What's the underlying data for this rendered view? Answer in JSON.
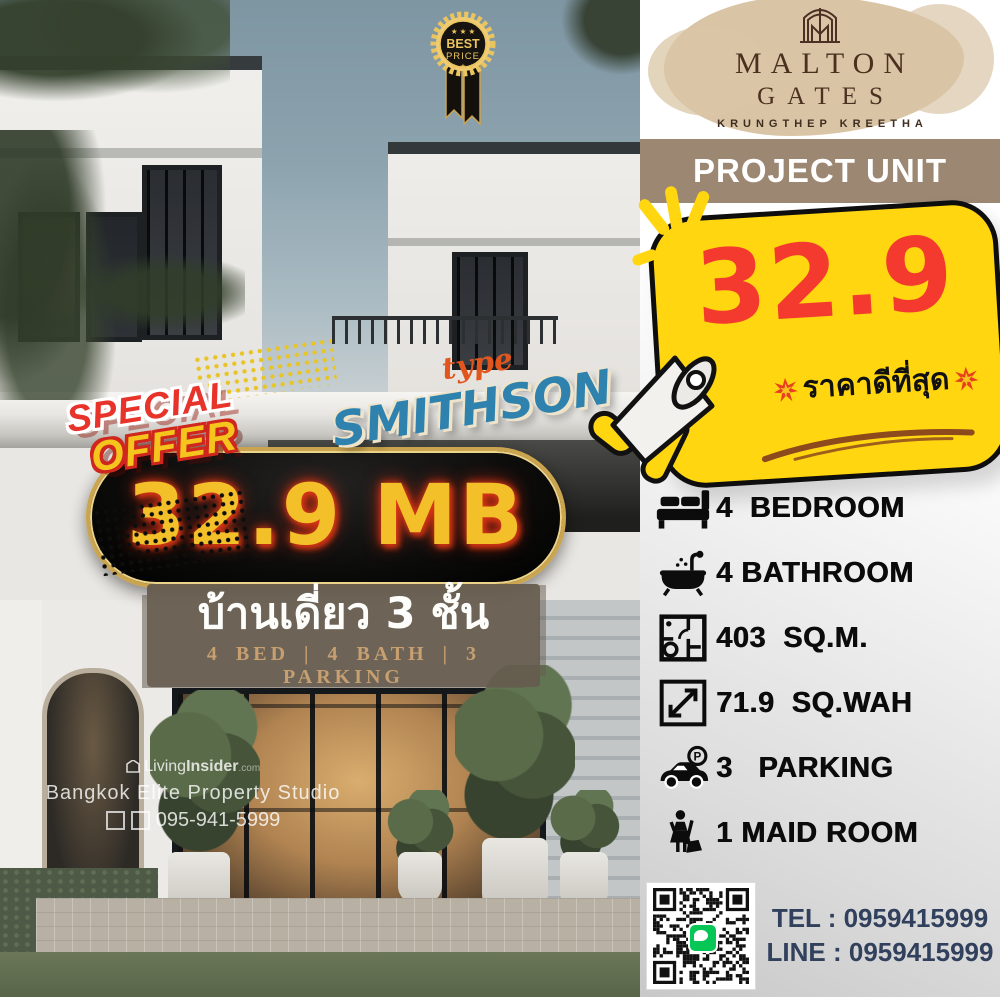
{
  "badges": {
    "best_price": {
      "stars_top": "★ ★ ★",
      "line1": "BEST",
      "line2": "PRICE",
      "stars_bottom": "★ ★ ★"
    },
    "special_offer": {
      "line1": "SPECIAL",
      "line2": "OFFER"
    }
  },
  "type_label": {
    "prefix": "type",
    "name": "SMITHSON"
  },
  "price_tag": {
    "value": "32.9 MB"
  },
  "thai_banner": {
    "title": "บ้านเดี่ยว 3 ชั้น",
    "subtitle": "4 BED | 4 BATH | 3 PARKING"
  },
  "watermark": {
    "brand_light": "Living",
    "brand_bold": "Insider",
    "brand_suffix": ".com",
    "studio": "Bangkok Elite Property Studio",
    "phone": "095-941-5999"
  },
  "brand": {
    "name1": "MALTON",
    "name2": "GATES",
    "location": "KRUNGTHEP KREETHA"
  },
  "header": {
    "title": "PROJECT UNIT"
  },
  "price_bubble": {
    "price": "32.9",
    "caption": "ราคาดีที่สุด"
  },
  "features": [
    {
      "icon": "bed-icon",
      "label": "4  BEDROOM"
    },
    {
      "icon": "bathtub-icon",
      "label": "4 BATHROOM"
    },
    {
      "icon": "floorplan-icon",
      "label": "403  SQ.M."
    },
    {
      "icon": "area-icon",
      "label": "71.9  SQ.WAH"
    },
    {
      "icon": "parking-icon",
      "label": "3   PARKING"
    },
    {
      "icon": "maid-icon",
      "label": "1 MAID ROOM"
    }
  ],
  "contact": {
    "tel": "TEL : 0959415999",
    "line": "LINE : 0959415999"
  },
  "colors": {
    "bubble_yellow": "#FFD60F",
    "price_red": "#F43A2E",
    "banner_taupe": "#9C8773",
    "splash_beige": "#D9C5A6",
    "pill_gold": "#CAA44E",
    "pill_text": "#F3C02A",
    "contact_navy": "#31405C",
    "line_green": "#06C755",
    "swoosh_brown": "#8C4A1D",
    "smithson_blue": "#2E82AD",
    "type_orange": "#E2561D"
  }
}
